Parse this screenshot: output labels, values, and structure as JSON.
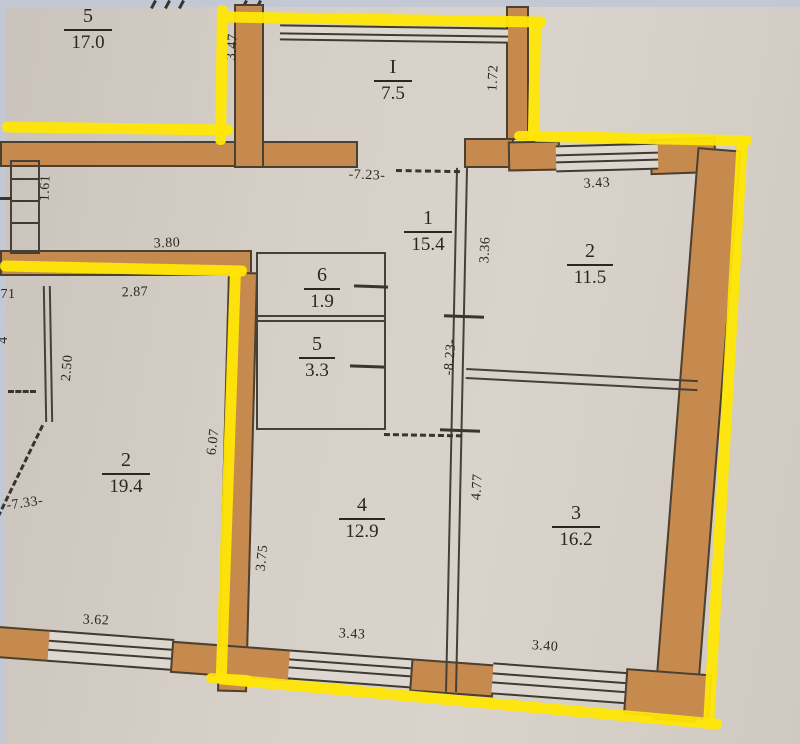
{
  "document": {
    "kind": "apartment floor plan photo",
    "annotation": "yellow highlighter outline around apartment boundary"
  },
  "colors": {
    "wall_fill": "#c78a4e",
    "line": "#45403a",
    "highlight": "#ffe606",
    "paper": "#d6d0c8"
  },
  "rooms": [
    {
      "id": "neighbor-top-left",
      "number": "5",
      "area": "17.0"
    },
    {
      "id": "loggia",
      "number": "I",
      "area": "7.5"
    },
    {
      "id": "hallway",
      "number": "1",
      "area": "15.4"
    },
    {
      "id": "room-2-right",
      "number": "2",
      "area": "11.5"
    },
    {
      "id": "storage-6",
      "number": "6",
      "area": "1.9"
    },
    {
      "id": "storage-5",
      "number": "5",
      "area": "3.3"
    },
    {
      "id": "neighbor-left",
      "number": "2",
      "area": "19.4"
    },
    {
      "id": "room-4",
      "number": "4",
      "area": "12.9"
    },
    {
      "id": "room-3",
      "number": "3",
      "area": "16.2"
    }
  ],
  "dims": {
    "v1_61": "1.61",
    "v3_47": "3.47",
    "v1_72": "1.72",
    "h7_23": "-7.23-",
    "h3_80": "3.80",
    "h2_87": "2.87",
    "h71": "71",
    "v4": "4",
    "v2_50": "2.50",
    "h7_33": "-7.33-",
    "v6_07": "6.07",
    "v3_36": "3.36",
    "v8_23": "-8.23-",
    "h3_43_top": "3.43",
    "v4_77": "4.77",
    "v3_75": "3.75",
    "h3_62": "3.62",
    "h3_43_bottom": "3.43",
    "h3_40": "3.40"
  }
}
